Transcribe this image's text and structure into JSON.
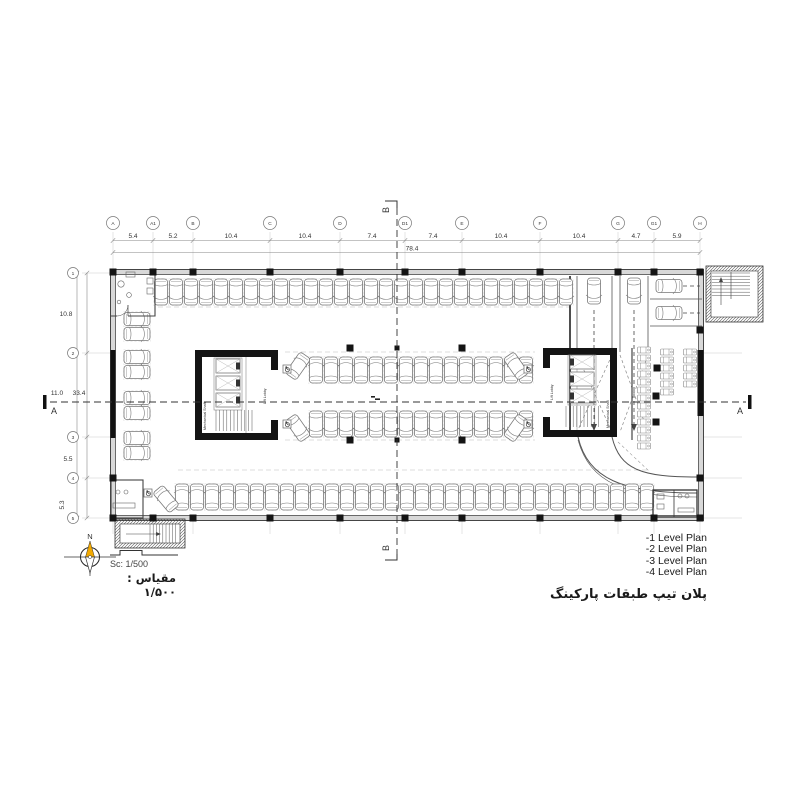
{
  "grid": {
    "columns": [
      "A",
      "A1",
      "B",
      "C",
      "D",
      "D1",
      "E",
      "F",
      "G",
      "G1",
      "H"
    ],
    "rows": [
      "1",
      "2",
      "3",
      "4",
      "5"
    ],
    "col_dims": [
      "5.4",
      "5.2",
      "10.4",
      "10.4",
      "7.4",
      "7.4",
      "10.4",
      "10.4",
      "4.7",
      "5.9"
    ],
    "col_total": "78.4",
    "row_dims": [
      "10.8",
      "11.0",
      "5.5",
      "5.3"
    ],
    "row_total": "33.4"
  },
  "sections": {
    "a": "A",
    "b": "B"
  },
  "cores": {
    "lift_lobby": "Lift Lobby",
    "mechanical_shaft": "Mechanical Shaft"
  },
  "compass": {
    "north": "N"
  },
  "scale_block": {
    "sc": "Sc: 1/500",
    "fa": "مقیاس : ۱/۵۰۰"
  },
  "title_block": {
    "levels": [
      "-1 Level Plan",
      "-2 Level Plan",
      "-3 Level Plan",
      "-4 Level Plan"
    ],
    "title_fa": "پلان تیپ طبقات پارکینگ"
  },
  "colors": {
    "compass_needle": "#f2a900",
    "wall": "#141414",
    "grid_line": "#c9c9c9"
  }
}
